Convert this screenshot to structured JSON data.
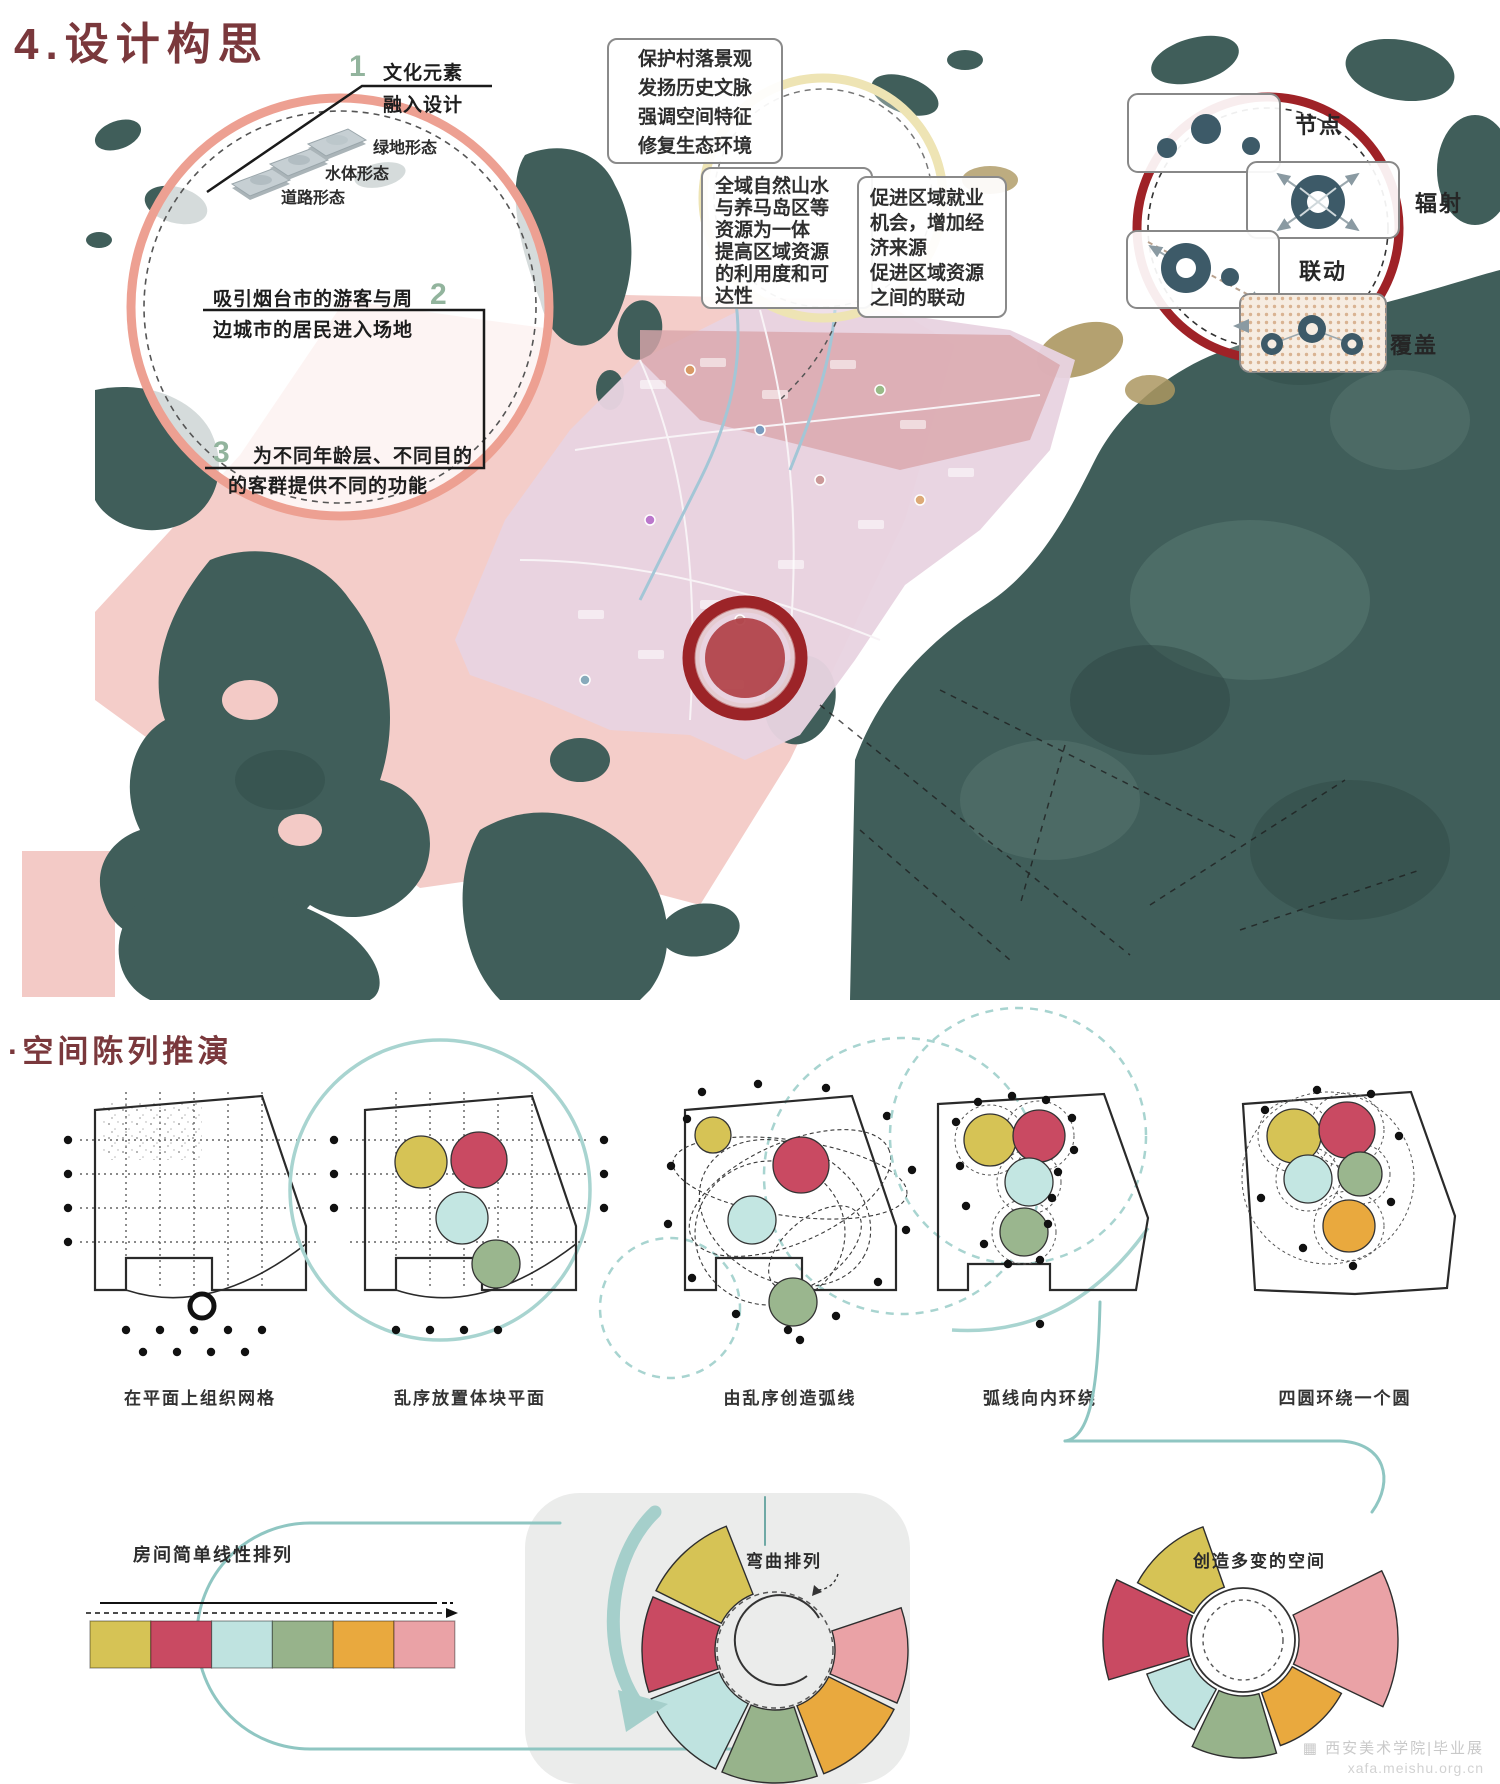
{
  "page": {
    "title": "4.设计构思",
    "section2_title": "·空间陈列推演"
  },
  "concept_circle": {
    "point1_num": "1",
    "point1_line1": "文化元素",
    "point1_line2": "融入设计",
    "tile_labels": [
      "绿地形态",
      "水体形态",
      "道路形态"
    ],
    "point2_num": "2",
    "point2_line1": "吸引烟台市的游客与周",
    "point2_line2": "边城市的居民进入场地",
    "point3_num": "3",
    "point3_line1": "为不同年龄层、不同目的",
    "point3_line2": "的客群提供不同的功能"
  },
  "goal_boxes": {
    "box1": [
      "保护村落景观",
      "发扬历史文脉",
      "强调空间特征",
      "修复生态环境"
    ],
    "box2": [
      "全域自然山水",
      "与养马岛区等",
      "资源为一体",
      "提高区域资源",
      "的利用度和可",
      "达性"
    ],
    "box3": [
      "促进区域就业",
      "机会，增加经",
      "济来源",
      "促进区域资源",
      "之间的联动"
    ]
  },
  "strategy_circle": {
    "node_label": "节点",
    "radiate_label": "辐射",
    "linkage_label": "联动",
    "coverage_label": "覆盖"
  },
  "deduction_steps": {
    "captions": [
      "在平面上组织网格",
      "乱序放置体块平面",
      "由乱序创造弧线",
      "弧线向内环绕",
      "四圆环绕一个圆"
    ]
  },
  "arrangement": {
    "linear_label": "房间简单线性排列",
    "curved_label": "弯曲排列",
    "varied_label": "创造多变的空间",
    "block_colors": [
      "#d6c355",
      "#c94a62",
      "#bfe3e0",
      "#97b38b",
      "#e9a93e",
      "#eaa2a6"
    ]
  },
  "palette": {
    "accent_maroon": "#7a383c",
    "teal_line": "#8fc6c2",
    "map_dark": "#405e5a",
    "map_tan": "#ac9760",
    "overlay_pink": "#f3cac6",
    "site_lavender": "#e8d3e1",
    "ring_red": "#9c2428",
    "circle_salmon": "#eda092",
    "circle_yellow": "#eee4b4",
    "icon_slate": "#3d5a68",
    "numeral_green": "#92b49d"
  },
  "watermark": {
    "line1": "西安美术学院|毕业展",
    "line2": "xafa.meishu.org.cn"
  }
}
